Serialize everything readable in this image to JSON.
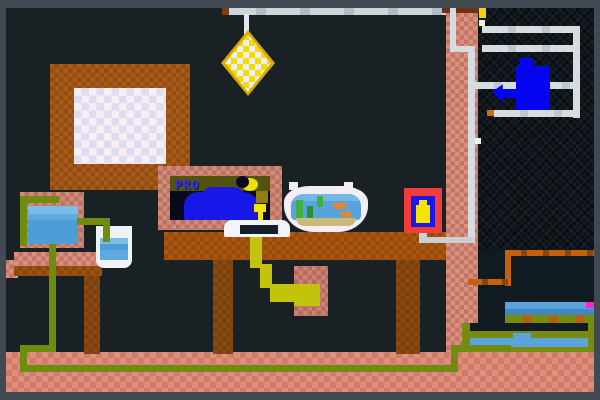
{
  "scene": {
    "title": "Pixel art room with desk, monitor and fishbowl",
    "visible_text": [
      "PRO"
    ],
    "monitor": {
      "screen_text": "PRO"
    },
    "objects": [
      "hanging-lamp",
      "ceiling-rod",
      "picture-frame",
      "wall-pillar",
      "desk",
      "computer-monitor",
      "keyboard",
      "fishbowl",
      "power-outlet",
      "wall-pipes",
      "blue-kettle",
      "side-table",
      "water-bucket",
      "water-glass",
      "pc-box",
      "yellow-power-pack",
      "shelf-stack",
      "green-cable",
      "yellow-cable",
      "outlet-cable",
      "floor"
    ],
    "palette": {
      "frame_border": "#414a52",
      "room_bg": "#192125",
      "recess_bg": "#0d141a",
      "floor_salmon": "#e08f7e",
      "pillar_salmon": "#df8e7e",
      "monitor_salmon": "#d5897b",
      "wood_brown": "#ad560f",
      "wood_dark": "#8a4a10",
      "picture_inner": "#f8eef4",
      "lamp_yellow": "#f6d90a",
      "lamp_white": "#eef0ee",
      "pipe_gray": "#d6dde1",
      "cable_green": "#6f8c0f",
      "cable_yellow": "#c3c30c",
      "water_blue": "#58a4da",
      "water_light": "#7cbce8",
      "screen_navy": "#0a0a1e",
      "screen_strip_olive": "#53530b",
      "screen_text_blue": "#3434da",
      "blob_blue": "#1717e8",
      "moon_yellow": "#f0e000",
      "outlet_red": "#f23d3d",
      "outlet_blue": "#1a1ae8",
      "plug_yellow": "#f5e400",
      "kettle_blue": "#0404f2",
      "fish_orange": "#e8872a",
      "plant_green": "#3faf3f",
      "sand_tan": "#c9b97b",
      "magenta_pixel": "#f428c8",
      "shelf_olive": "#778c0e",
      "shelf_orange": "#c2620f"
    }
  }
}
